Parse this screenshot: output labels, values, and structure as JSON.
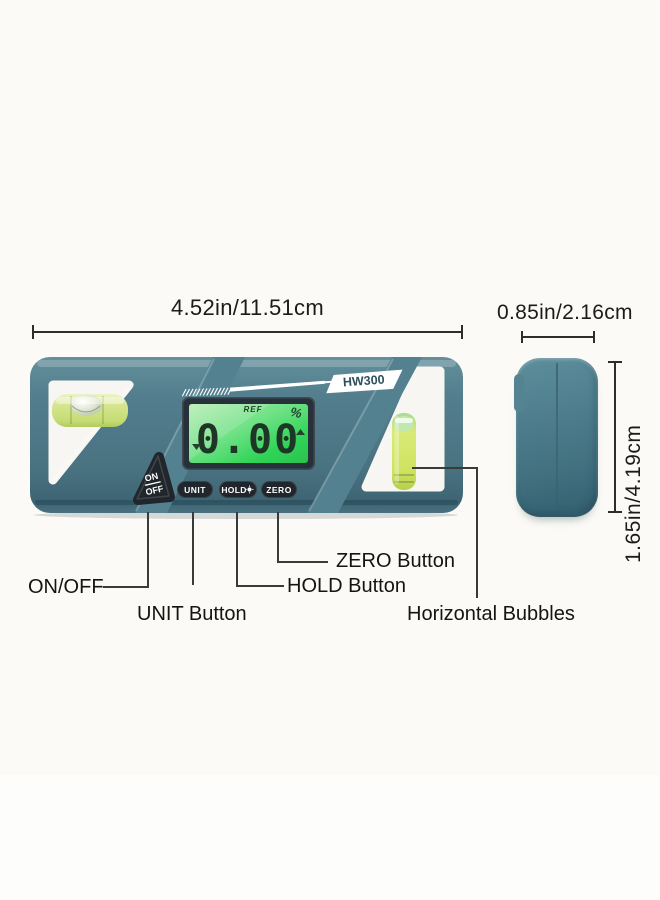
{
  "product": {
    "model": "HW300",
    "display": {
      "ref_label": "REF",
      "percent_symbol": "%",
      "value": "0.00"
    },
    "buttons": {
      "on_off_line1": "ON",
      "on_off_line2": "OFF",
      "unit": "UNIT",
      "hold": "HOLD",
      "zero": "ZERO"
    }
  },
  "dimensions": {
    "width_label": "4.52in/11.51cm",
    "depth_label": "0.85in/2.16cm",
    "height_label": "1.65in/4.19cm"
  },
  "callouts": {
    "on_off": "ON/OFF",
    "unit": "UNIT Button",
    "hold": "HOLD Button",
    "zero": "ZERO Button",
    "bubbles": "Horizontal Bubbles"
  },
  "colors": {
    "body_teal": "#4b7685",
    "button_dark": "#20262b",
    "lcd_green": "#3ed95b",
    "vial_green": "#d3e56f",
    "annotation_dark": "#2d2d2d"
  }
}
